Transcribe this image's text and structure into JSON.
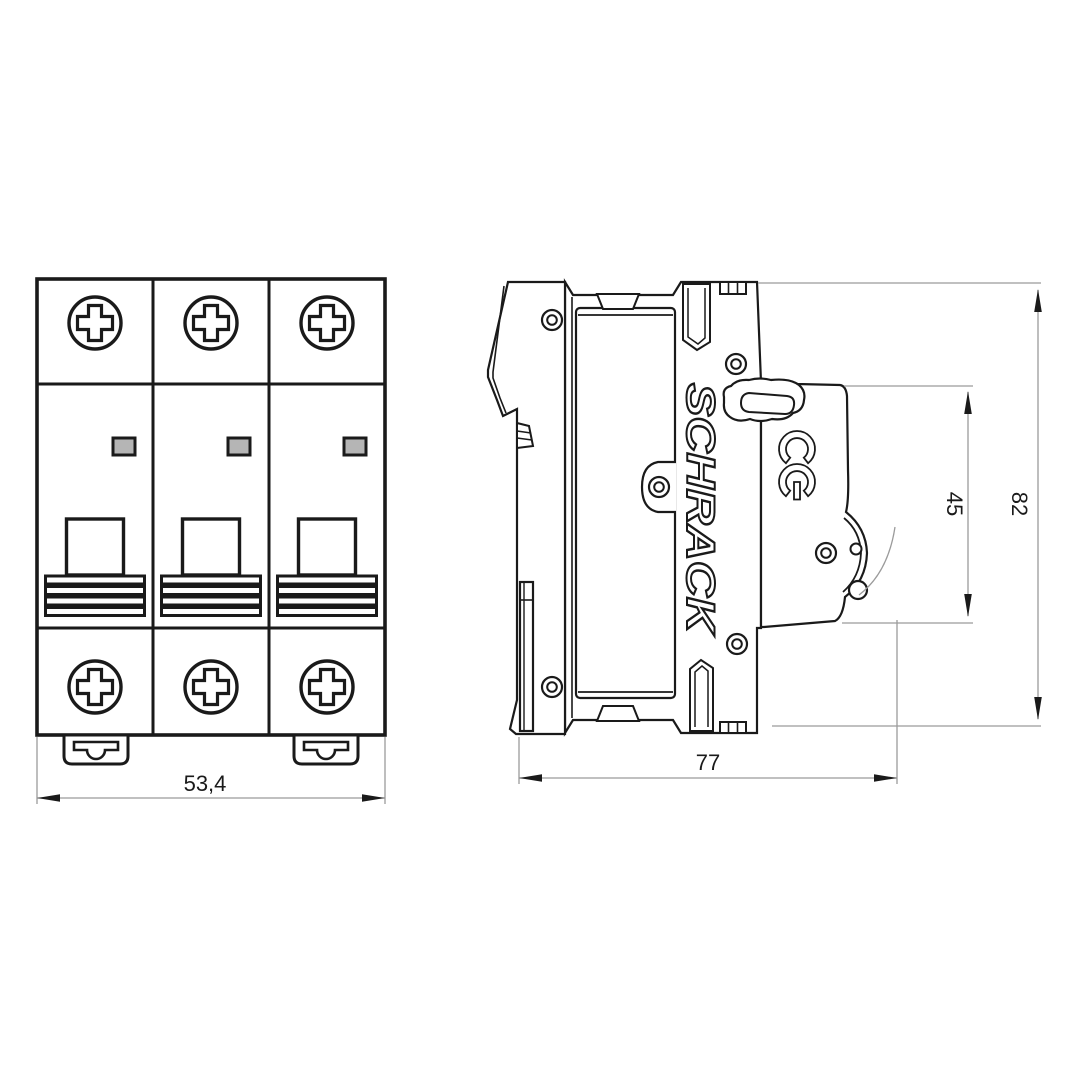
{
  "drawing": {
    "brand_marking": "SCHRACK",
    "certification_marking": "CE",
    "front_view": {
      "poles": 3,
      "width_dimension": "53,4"
    },
    "side_view": {
      "depth_dimension": "77",
      "front_section_dimension": "45",
      "height_dimension": "82"
    }
  },
  "colors": {
    "background": "#ffffff",
    "line": "#1a1a1a",
    "dimension_line": "#9b9b9b",
    "dimension_text": "#1a1a1a",
    "indicator_window_fill": "#b5b5b5"
  }
}
